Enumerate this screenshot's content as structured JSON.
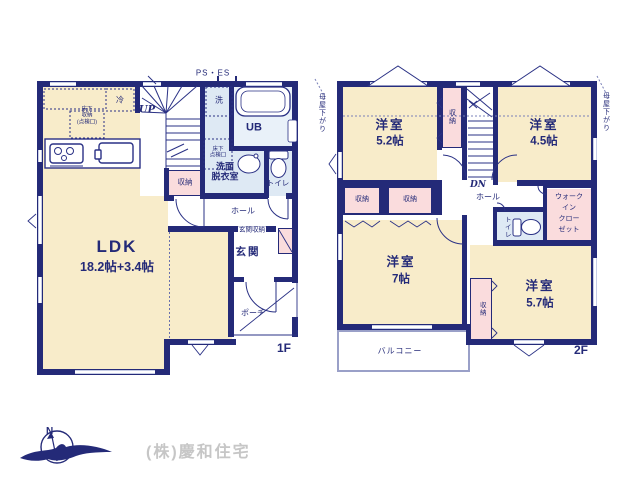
{
  "floor1": {
    "floor_label": "1F",
    "ldk": {
      "name": "LDK",
      "size": "18.2帖+3.4帖"
    },
    "genkan": "玄関",
    "genkan_storage": "玄関収納",
    "porch": "ポーチ",
    "hall": "ホール",
    "toilet": "トイレ",
    "washroom": [
      "洗面",
      "脱衣室"
    ],
    "ub": "UB",
    "wash": "洗",
    "storage": "収納",
    "fridge": "冷",
    "underfloor_storage": [
      "床下",
      "収納",
      "(点検口)"
    ],
    "underfloor_hatch": [
      "床下",
      "点検口"
    ],
    "ps_es": "PS・ES",
    "up": "UP"
  },
  "floor2": {
    "floor_label": "2F",
    "room_5_2": {
      "name": "洋室",
      "size": "5.2帖"
    },
    "room_4_5": {
      "name": "洋室",
      "size": "4.5帖"
    },
    "room_7": {
      "name": "洋室",
      "size": "7帖"
    },
    "room_5_7": {
      "name": "洋室",
      "size": "5.7帖"
    },
    "closet_strip_top": "収納",
    "closet_left": "収納",
    "closet_mid": "収納",
    "closet_strip_bottom": "収納",
    "wic": [
      "ウォーク",
      "イン",
      "クロー",
      "ゼット"
    ],
    "toilet": "トイレ",
    "hall": "ホール",
    "balcony": "バルコニー",
    "dn": "DN",
    "moya_left": "母屋下がり",
    "moya_right": "母屋下がり"
  },
  "footer": {
    "compass_n": "N",
    "company": "(株)慶和住宅"
  },
  "colors": {
    "wall": "#242a78",
    "room": "#f8ecca",
    "closet": "#fadcdd",
    "wet": "#dee9f4"
  }
}
